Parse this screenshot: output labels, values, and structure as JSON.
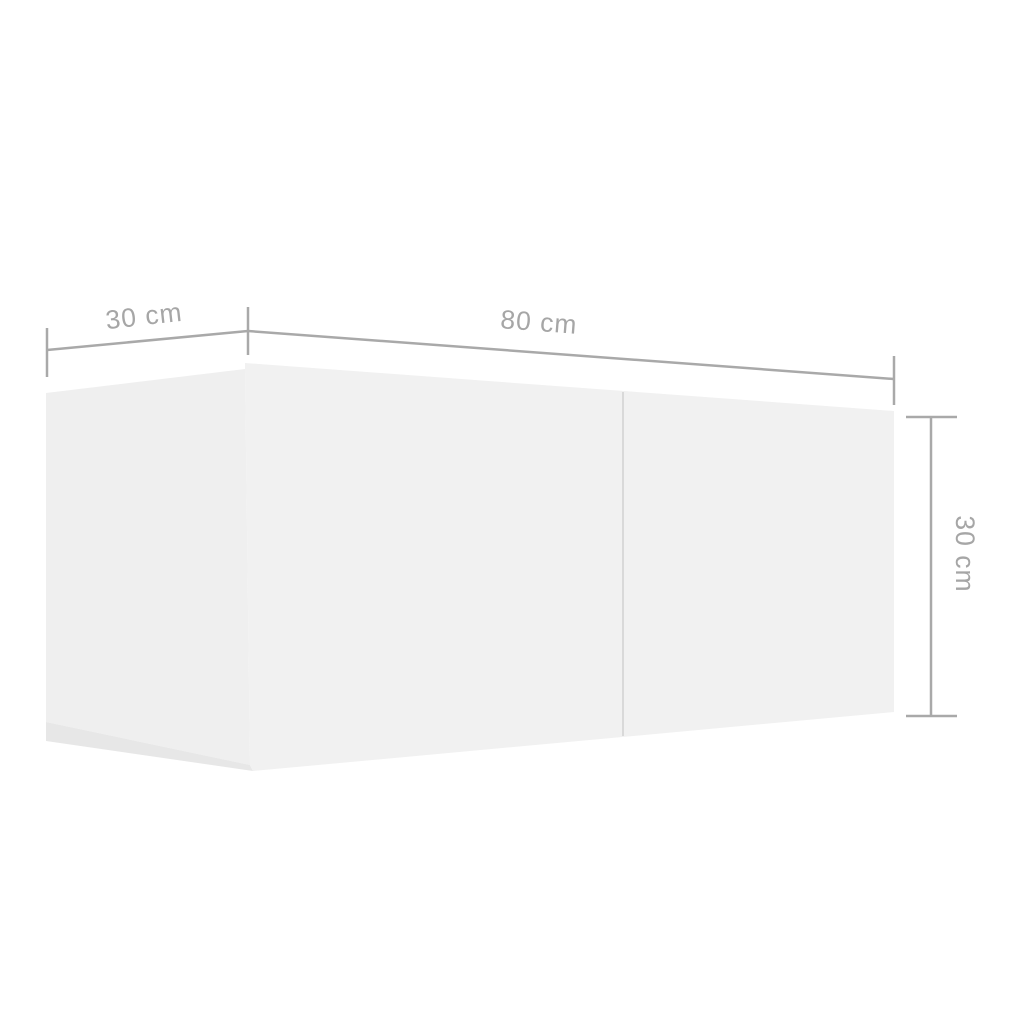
{
  "diagram": {
    "background_color": "#ffffff",
    "cabinet": {
      "description": "white two-section wall-mounted cabinet shown in perspective",
      "front_face_color": "#f1f1f1",
      "side_face_color": "#efefef",
      "bottom_edge_color": "#e7e7e7",
      "seam_color": "#d9d9d9"
    },
    "dimension_style": {
      "line_color": "#a9a9a9",
      "label_color": "#a6a6a6"
    },
    "dimensions": {
      "depth": {
        "label": "30 cm",
        "value_cm": 30,
        "position": "top-left"
      },
      "width": {
        "label": "80 cm",
        "value_cm": 80,
        "position": "top"
      },
      "height": {
        "label": "30 cm",
        "value_cm": 30,
        "position": "right"
      }
    }
  }
}
